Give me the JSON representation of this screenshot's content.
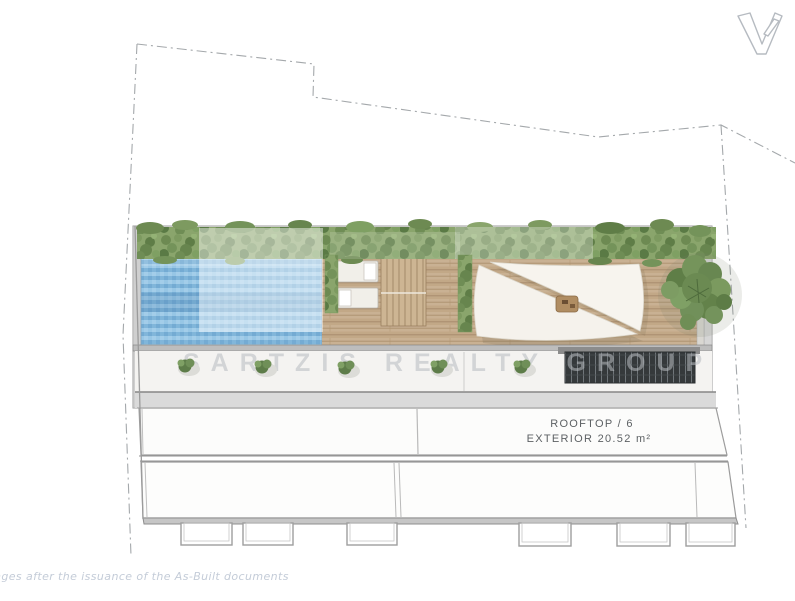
{
  "logo": {
    "icon": "brand-v-logo",
    "letter": "V"
  },
  "watermark": {
    "text": "SARTZIS REALTY GROUP"
  },
  "labels": {
    "room": "ROOFTOP / 6",
    "area": "EXTERIOR 20.52 m²"
  },
  "footer": {
    "disclaimer": "nges after the issuance of the As-Built documents"
  },
  "colors": {
    "pool_blue": "#8bbede",
    "pool_blue_light": "#a6cfea",
    "deck_wood": "#c9b193",
    "deck_line": "#aa8f6d",
    "greenery_dark": "#5f7e47",
    "greenery_mid": "#74935a",
    "greenery_light": "#8aa56c",
    "sail_white": "#f5f2ec",
    "grate_dark": "#35393b",
    "parapet_gray": "#dadada",
    "wall_line_gray": "#9b9b9b",
    "boundary_gray": "#a4a8ab",
    "watermark_gray": "#b8bcc0",
    "label_gray": "#5d6164",
    "disclaimer_gray": "#c4ccd8",
    "logo_gray": "#b6bbc1",
    "highlight_overlay": "rgba(255,255,255,0.45)"
  }
}
